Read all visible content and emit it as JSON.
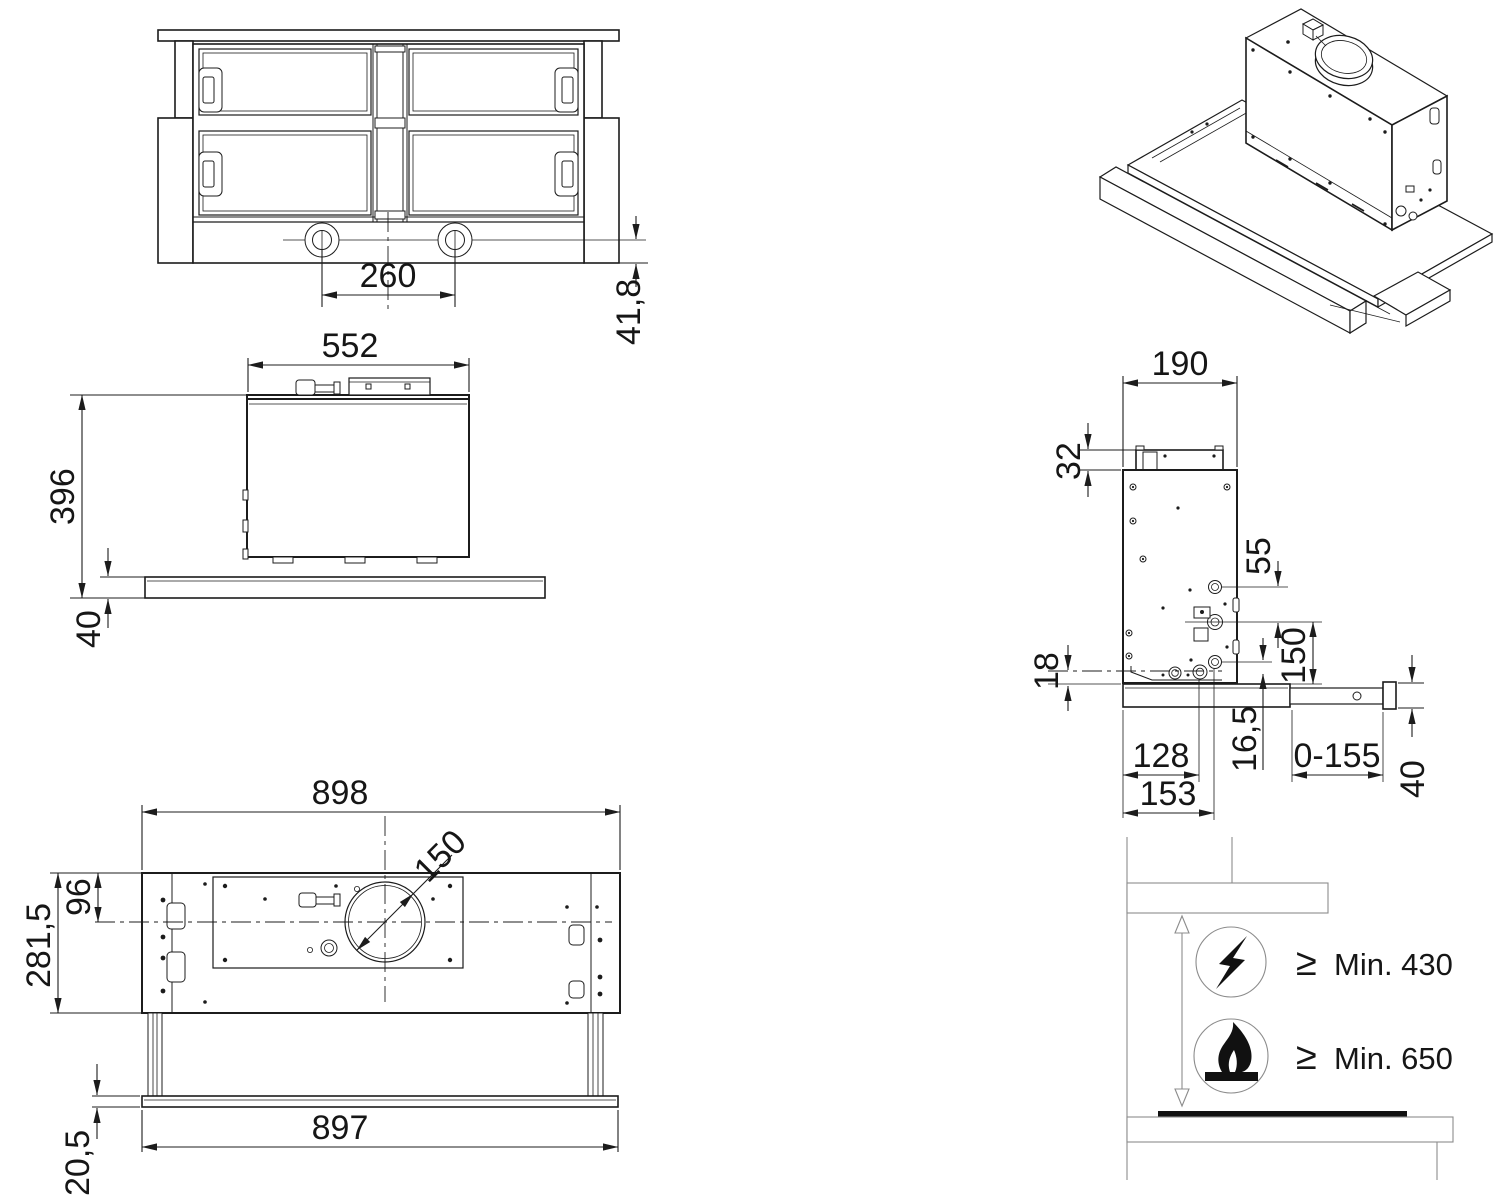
{
  "page": {
    "background": "#ffffff",
    "line_color": "#1c1c1c"
  },
  "bottom_view": {
    "lamp_spacing": "260",
    "visor_offset": "41,8"
  },
  "front_view": {
    "body_width": "552",
    "total_height": "396",
    "visor_thickness": "40"
  },
  "top_view": {
    "body_width": "898",
    "duct_diameter": "150",
    "duct_center_offset": "96",
    "body_depth": "281,5",
    "visor_width": "897",
    "visor_drop": "20,5"
  },
  "side_view": {
    "body_depth": "190",
    "collar_height": "32",
    "fitting_spacing": "55",
    "outlet_offset": "150",
    "rear_gap": "18",
    "flange_offset": "16,5",
    "slide_depth": "128",
    "fitting_depth": "153",
    "visor_travel": "0-155",
    "front_height": "40"
  },
  "clearance_view": {
    "electric_symbol": "≥",
    "electric_min": "Min. 430",
    "gas_symbol": "≥",
    "gas_min": "Min. 650"
  }
}
